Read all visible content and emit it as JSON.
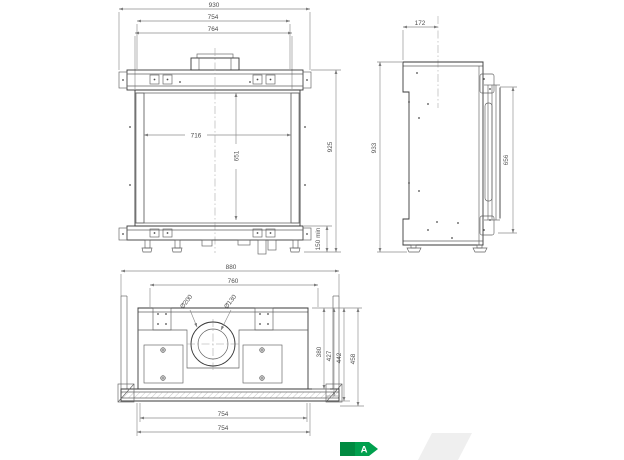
{
  "front": {
    "width_overall": "930",
    "width_frame": "754",
    "width_inner": "764",
    "glass_width": "716",
    "glass_height": "651",
    "height_overall": "925",
    "base_clearance": "150 min"
  },
  "side": {
    "top_depth": "172",
    "height_overall": "933",
    "door_height": "656"
  },
  "plan": {
    "width_overall": "880",
    "width_inner": "760",
    "flue_outer": "Ø200",
    "flue_inner": "Ø130",
    "depth_1": "380",
    "depth_2": "427",
    "depth_3": "442",
    "depth_4": "458",
    "front_width_1": "754",
    "front_width_2": "754"
  },
  "energy_badge": {
    "class_label": "A",
    "color": "#00a04e",
    "color_dark": "#008a41"
  },
  "watermark_color": "#efefef"
}
